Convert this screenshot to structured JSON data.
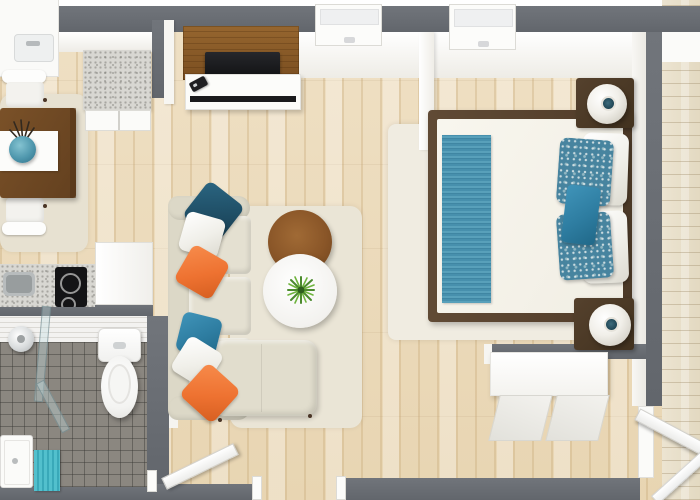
{
  "scene": {
    "type": "3d-floor-plan-render",
    "description": "Top-down 3D rendering of a studio apartment floor plan",
    "windows_visible": 3,
    "open_doors_visible": 2
  },
  "palette": {
    "wall": "#686c72",
    "apartment_floor": "#ecdcbd",
    "hallway_floor": "#e9e1cd",
    "bathroom_tile": "#8b8780",
    "living_rug": "#eae5d6",
    "bedroom_rug": "#f0ece1",
    "sofa": "#dcd8c7",
    "pillow_navy": "#1e4c63",
    "pillow_orange": "#ee7231",
    "pillow_teal": "#2e7da1",
    "bed_runner": "#4f99b5",
    "bath_mat": "#45b5c4",
    "dark_wood": "#6f4a26",
    "tv_panel_wood": "#8a5c2b"
  },
  "labels": {
    "canvas": "3D floor plan — studio apartment",
    "top_wall": "Exterior wall",
    "right_wall": "Bedroom wall",
    "bottom_wall": "Wall",
    "divider_wall": "Kitchen divider wall",
    "bathroom_wall": "Bathroom wall",
    "entry_wall": "Entry alcove wall",
    "window": "Window",
    "kitchen_counter": "Kitchen counter with sink",
    "kitchen_sink": "Kitchen sink",
    "kitchen_island": "Kitchen island (granite top)",
    "island_cabinet": "Island cabinet doors",
    "cooktop": "Black cooktop with burners",
    "prep_sink": "Stainless prep sink",
    "dining_rug": "Dining area rug",
    "dining_table": "Dark wood dining table",
    "table_runner": "White table runner",
    "vase": "Teal vase with twigs",
    "chair": "White dining chair",
    "living_rug": "Beige living room rug",
    "sofa": "L-shaped beige sofa",
    "sofa_chaise": "Sofa chaise section",
    "cushion": "Seat cushion",
    "pillow_navy": "Dark teal throw pillow",
    "pillow_white": "White throw pillow",
    "pillow_orange": "Orange throw pillow",
    "pillow_teal": "Teal throw pillow",
    "side_table": "Round wood side table",
    "coffee_table": "Round white coffee table",
    "plant": "Green potted plant",
    "tv_panel": "Wood TV feature panel",
    "tv": "Flat-screen TV",
    "console": "White media console",
    "remote": "TV remote",
    "bedroom_rug": "White bedroom rug",
    "bed": "Double bed with dark wood frame",
    "duvet": "White duvet",
    "bed_runner": "Teal striped bed runner",
    "pillow_floral": "Teal patterned pillow",
    "pillow_accent": "Solid teal accent pillow",
    "nightstand": "Dark wood nightstand",
    "lamp": "White sphere table lamp",
    "dresser": "White dresser",
    "tile_wall": "Tiled bathroom wall",
    "bathroom_floor": "Gray tiled bathroom floor",
    "shower_head": "Rain shower head",
    "shower_glass": "Glass shower panel",
    "shower_tray": "Shower tray",
    "bath_mat": "Teal bath mat",
    "toilet": "Toilet",
    "bathroom_door": "Open bathroom door",
    "entry_door": "Open entry door",
    "door_frame": "Door frame",
    "railing": "Stair railing",
    "hallway_floor": "Hallway plank flooring",
    "hallway_landing": "Hallway landing"
  },
  "rooms": [
    {
      "name": "kitchen",
      "items": [
        "corner counter with sink",
        "granite island",
        "granite counter with stainless sink and black cooktop"
      ]
    },
    {
      "name": "dining-area",
      "items": [
        "dark wood table",
        "white runner",
        "teal vase",
        "two white chairs",
        "beige rug"
      ]
    },
    {
      "name": "living-room",
      "items": [
        "L-shaped beige sofa",
        "six throw pillows (teal/white/orange)",
        "round wood side table",
        "round white coffee table with plant",
        "TV wood panel",
        "white media console",
        "remote"
      ]
    },
    {
      "name": "bedroom",
      "items": [
        "double bed",
        "teal striped runner",
        "white and teal pillows",
        "two nightstands with sphere lamps",
        "white rug",
        "white dresser"
      ]
    },
    {
      "name": "bathroom",
      "items": [
        "toilet",
        "glass shower",
        "rain shower head",
        "shower tray",
        "teal bath mat"
      ]
    },
    {
      "name": "hallway",
      "items": [
        "plank flooring",
        "open entry door",
        "stair railing"
      ]
    }
  ]
}
